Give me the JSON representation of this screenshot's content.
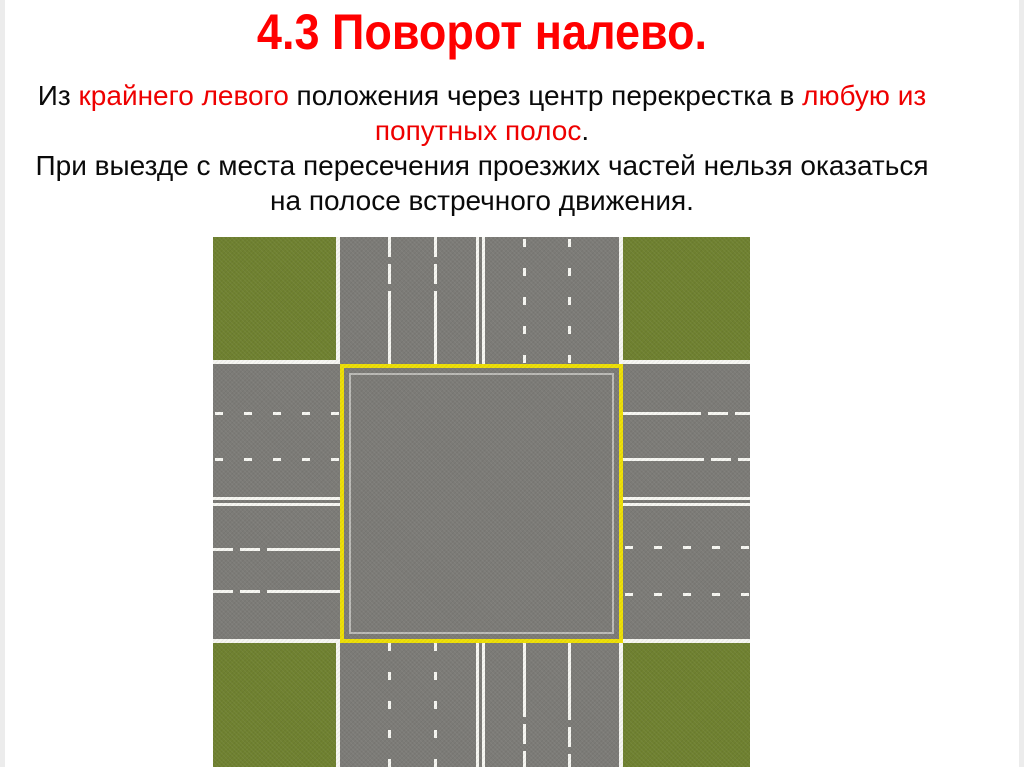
{
  "slide": {
    "title": "4.3 Поворот налево.",
    "body": {
      "lines": [
        [
          {
            "t": "Из ",
            "red": false
          },
          {
            "t": "крайнего левого",
            "red": true
          },
          {
            "t": " положения через центр перекрестка в ",
            "red": false
          },
          {
            "t": "любую из",
            "red": true
          }
        ],
        [
          {
            "t": "попутных полос",
            "red": true
          },
          {
            "t": ".",
            "red": false
          }
        ],
        [
          {
            "t": "При выезде с места пересечения проезжих частей нельзя оказаться",
            "red": false
          }
        ],
        [
          {
            "t": "на полосе встречного движения.",
            "red": false
          }
        ]
      ]
    },
    "diagram": {
      "name": "four-way-intersection-top-view",
      "elements": [
        "grass-corners",
        "six-lane-roads",
        "dashed-lane-lines",
        "double-center-lines",
        "yellow-intersection-outline"
      ]
    }
  },
  "theme": {
    "title_color": "#ff0000",
    "highlight_color": "#ee0000",
    "text_color": "#0a0a0a",
    "page_bg": "#ffffff",
    "edge_strip": "#ececec",
    "grass": "#6f8130",
    "road": "#7c7b77",
    "line": "#f7f7f2",
    "yellow": "#eedf05"
  }
}
